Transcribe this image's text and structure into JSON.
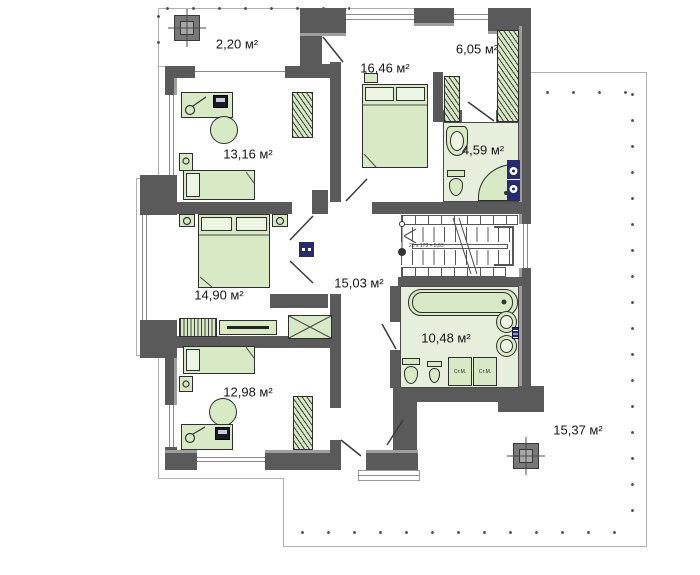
{
  "plan": {
    "type": "floor-plan",
    "unit": "м²",
    "rooms": [
      {
        "name": "balcony",
        "label": "2,20 м²"
      },
      {
        "name": "bedroom-top",
        "label": "16,46 м²"
      },
      {
        "name": "wardrobe-room",
        "label": "6,05 м²"
      },
      {
        "name": "bathroom-small",
        "label": "4,59 м²"
      },
      {
        "name": "bedroom-left",
        "label": "13,16 м²"
      },
      {
        "name": "bedroom-master",
        "label": "14,90 м²"
      },
      {
        "name": "hall",
        "label": "15,03 м²"
      },
      {
        "name": "bathroom-large",
        "label": "10,48 м²"
      },
      {
        "name": "bedroom-bottom",
        "label": "12,98 м²"
      },
      {
        "name": "terrace",
        "label": "15,37 м²"
      }
    ],
    "appliances": {
      "washing_machine_1": "Ст.М.",
      "washing_machine_2": "Ст.М."
    },
    "stairs": {
      "note": "20 x 173 = 5,63"
    },
    "icons": {
      "chimney": "square-with-crosshair",
      "double-bed": "green rect with two pillows",
      "single-bed": "green rect with one pillow",
      "wardrobe": "hatched green rect",
      "bathtub": "rounded green rect",
      "shower": "quarter-round green",
      "toilet": "green bowl",
      "sink": "green oval",
      "washer-stack": "navy rect with circles",
      "railing": "dotted post line"
    },
    "colors": {
      "wall": "#5a5a5a",
      "wall_light": "#9e9e9e",
      "furniture": "#d8e9c5",
      "bath_floor": "#e6efdb",
      "navy": "#272a6b",
      "outline": "#b0b0b0",
      "text": "#161616"
    }
  }
}
